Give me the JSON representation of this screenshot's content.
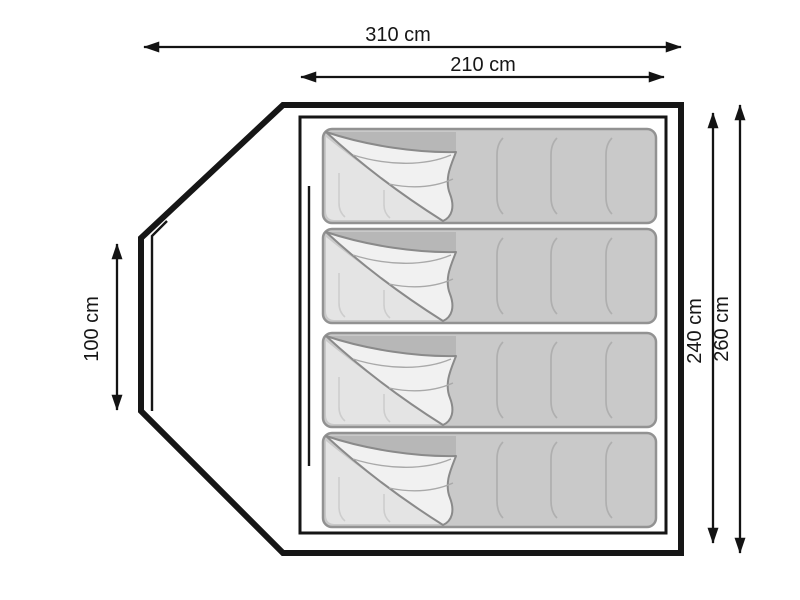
{
  "diagram": {
    "description": "Tent floor plan with four sleeping bags and dimension arrows",
    "sleeping_bag_count": 4
  },
  "dimensions": {
    "total_width": {
      "label": "310 cm"
    },
    "inner_width": {
      "label": "210 cm"
    },
    "side_height": {
      "label": "100 cm"
    },
    "inner_depth": {
      "label": "240 cm"
    },
    "total_depth": {
      "label": "260 cm"
    }
  },
  "colors": {
    "background": "#ffffff",
    "outline": "#161616",
    "bag_fill": "#c9c9c9",
    "bag_border": "#929292",
    "bag_lining": "#e4e4e4",
    "bag_flap": "#f1f1f1",
    "fold_shadow": "#b7b7b7",
    "seam_line": "#afafaf"
  }
}
